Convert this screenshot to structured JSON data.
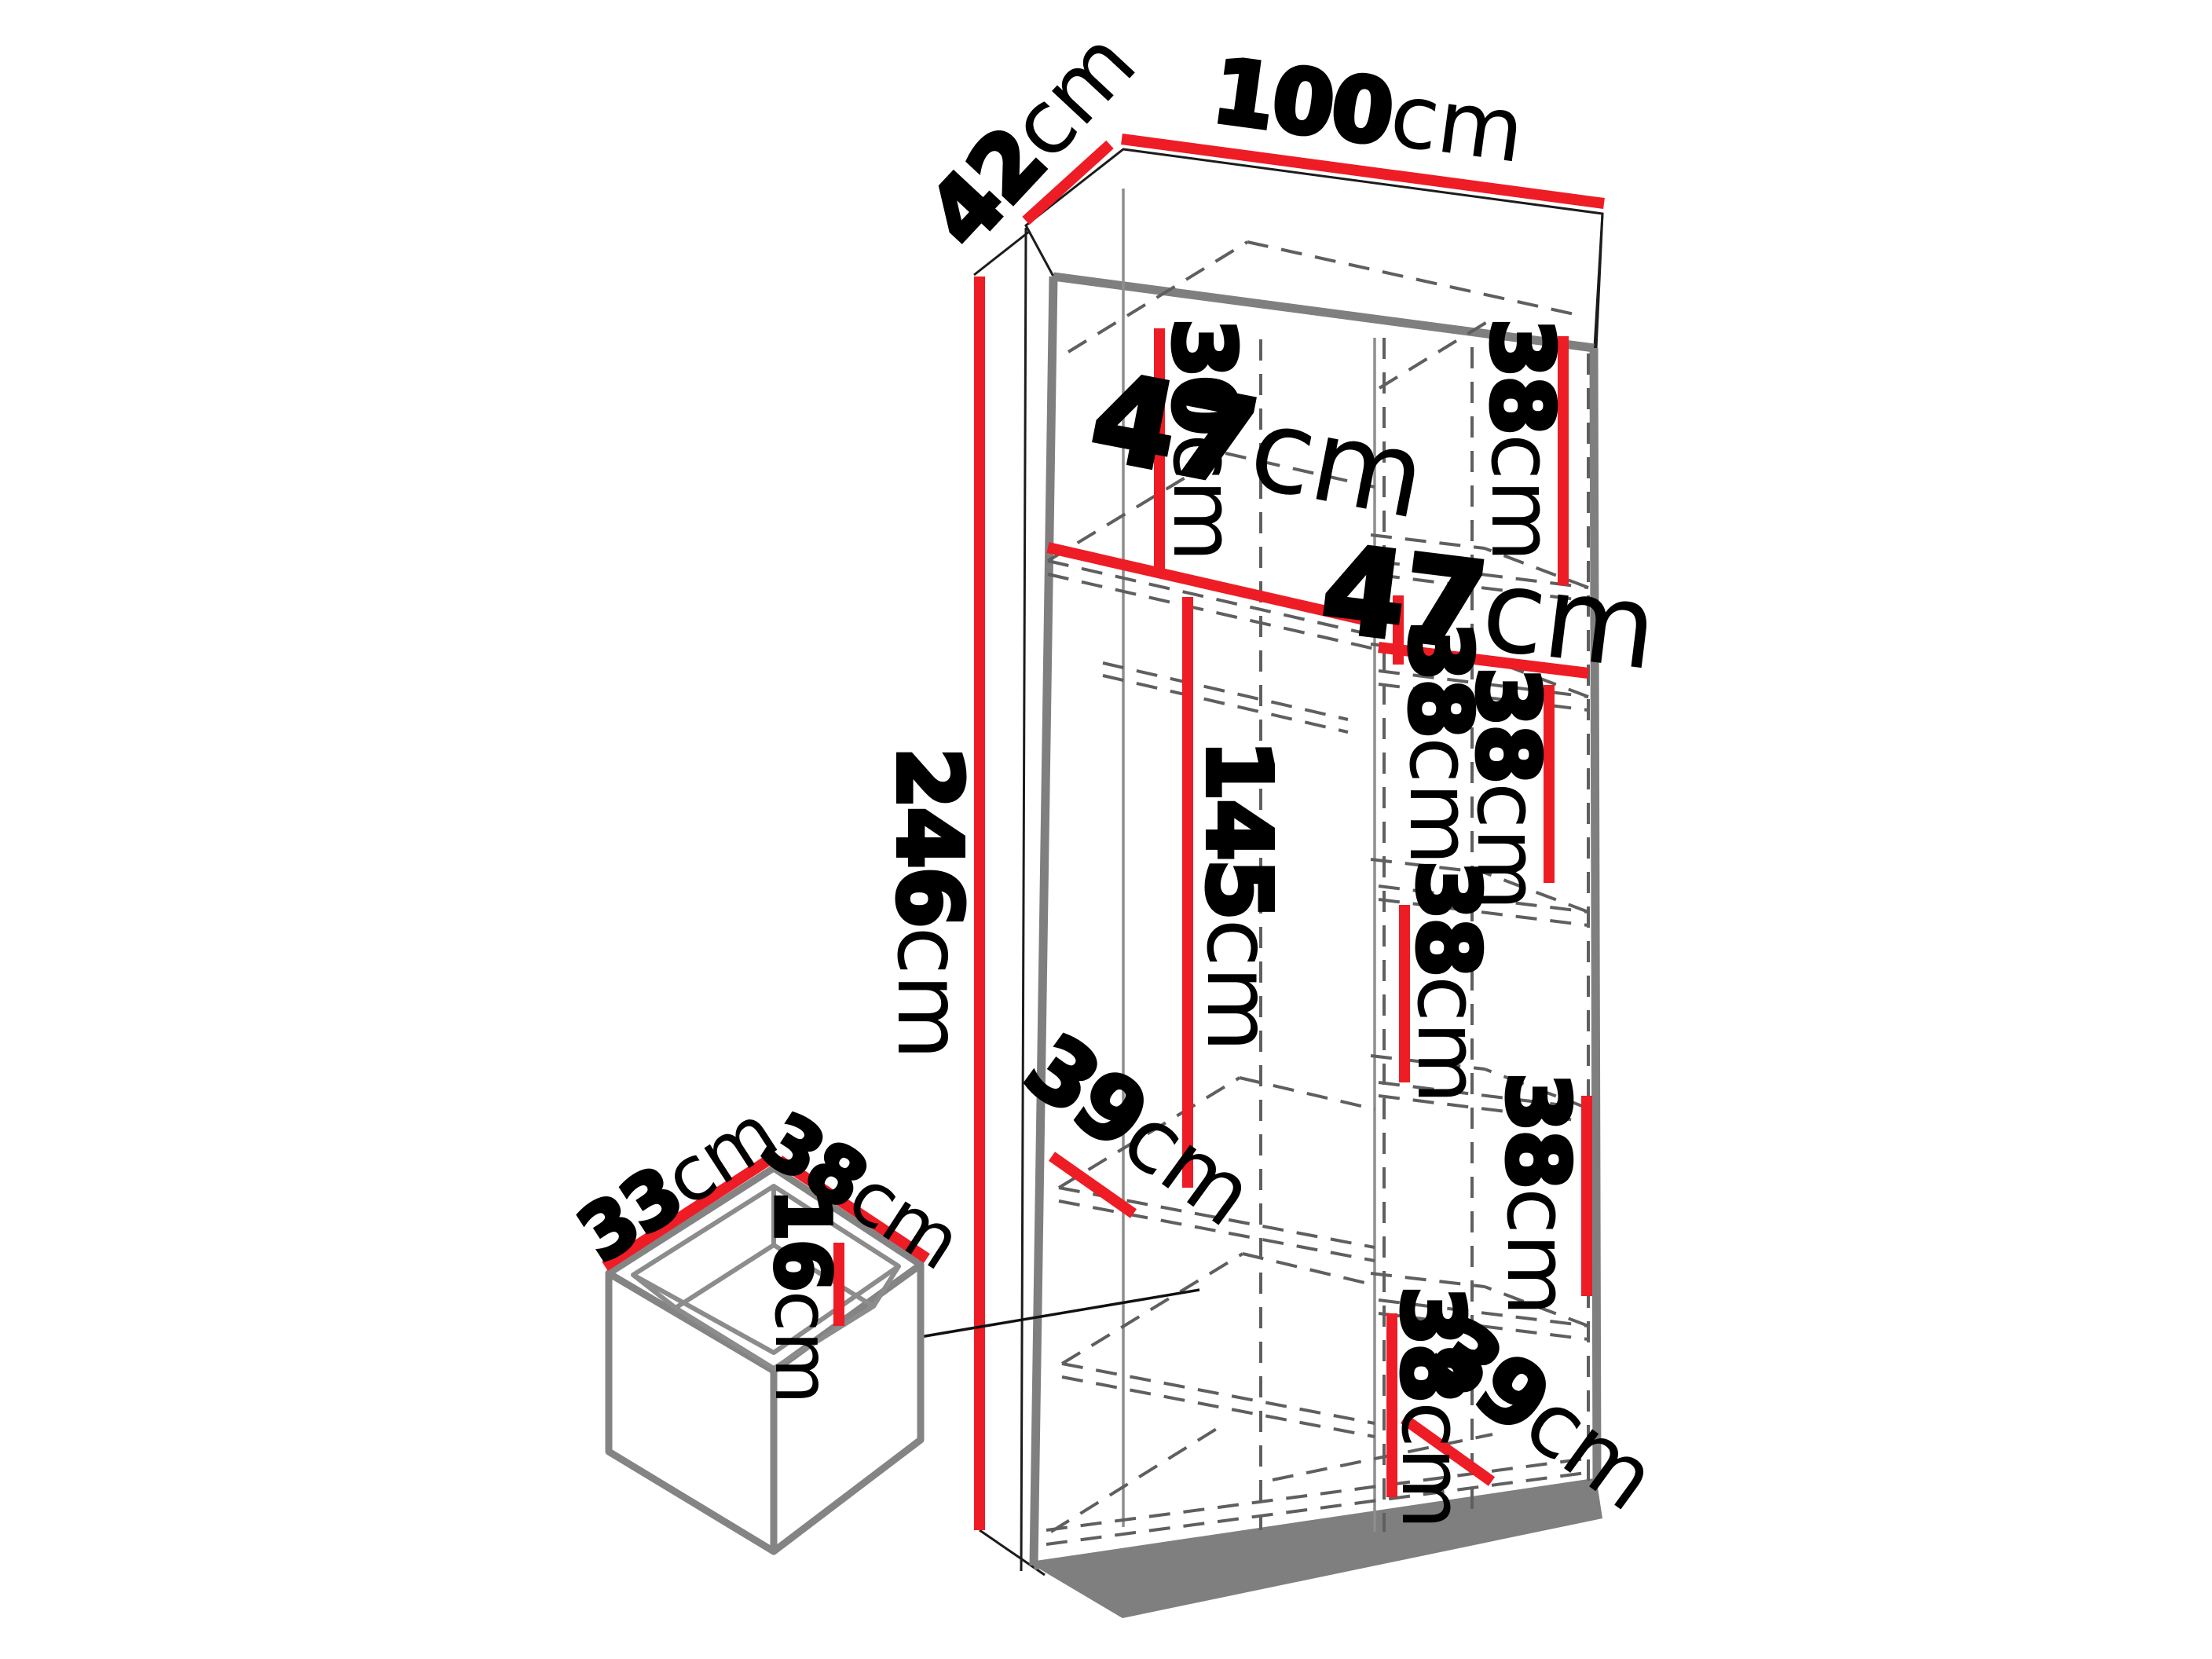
{
  "diagram": "wardrobe-dimension-drawing",
  "units": "cm",
  "colors": {
    "dimension_red": "#ee1c25",
    "carcass_gray": "#7f7f7f",
    "dash_gray": "#5f5f5f",
    "label_black": "#000000",
    "background": "#ffffff"
  },
  "overall": {
    "width": {
      "value": "100",
      "unit": "cm"
    },
    "depth": {
      "value": "42",
      "unit": "cm"
    },
    "height": {
      "value": "246",
      "unit": "cm"
    }
  },
  "interior": {
    "left_column": {
      "width": {
        "value": "47",
        "unit": "cm"
      },
      "top_shelf_height": {
        "value": "30",
        "unit": "cm"
      },
      "hanging_height": {
        "value": "145",
        "unit": "cm"
      },
      "shelf_depth": {
        "value": "39",
        "unit": "cm"
      }
    },
    "right_column": {
      "width": {
        "value": "47",
        "unit": "cm"
      },
      "shelf_heights": [
        {
          "value": "38",
          "unit": "cm"
        },
        {
          "value": "38",
          "unit": "cm"
        },
        {
          "value": "38",
          "unit": "cm"
        },
        {
          "value": "38",
          "unit": "cm"
        },
        {
          "value": "38",
          "unit": "cm"
        },
        {
          "value": "38",
          "unit": "cm"
        }
      ],
      "bottom_shelf_depth": {
        "value": "39",
        "unit": "cm"
      }
    }
  },
  "drawer": {
    "depth": {
      "value": "33",
      "unit": "cm"
    },
    "width": {
      "value": "38",
      "unit": "cm"
    },
    "height": {
      "value": "16",
      "unit": "cm"
    }
  }
}
